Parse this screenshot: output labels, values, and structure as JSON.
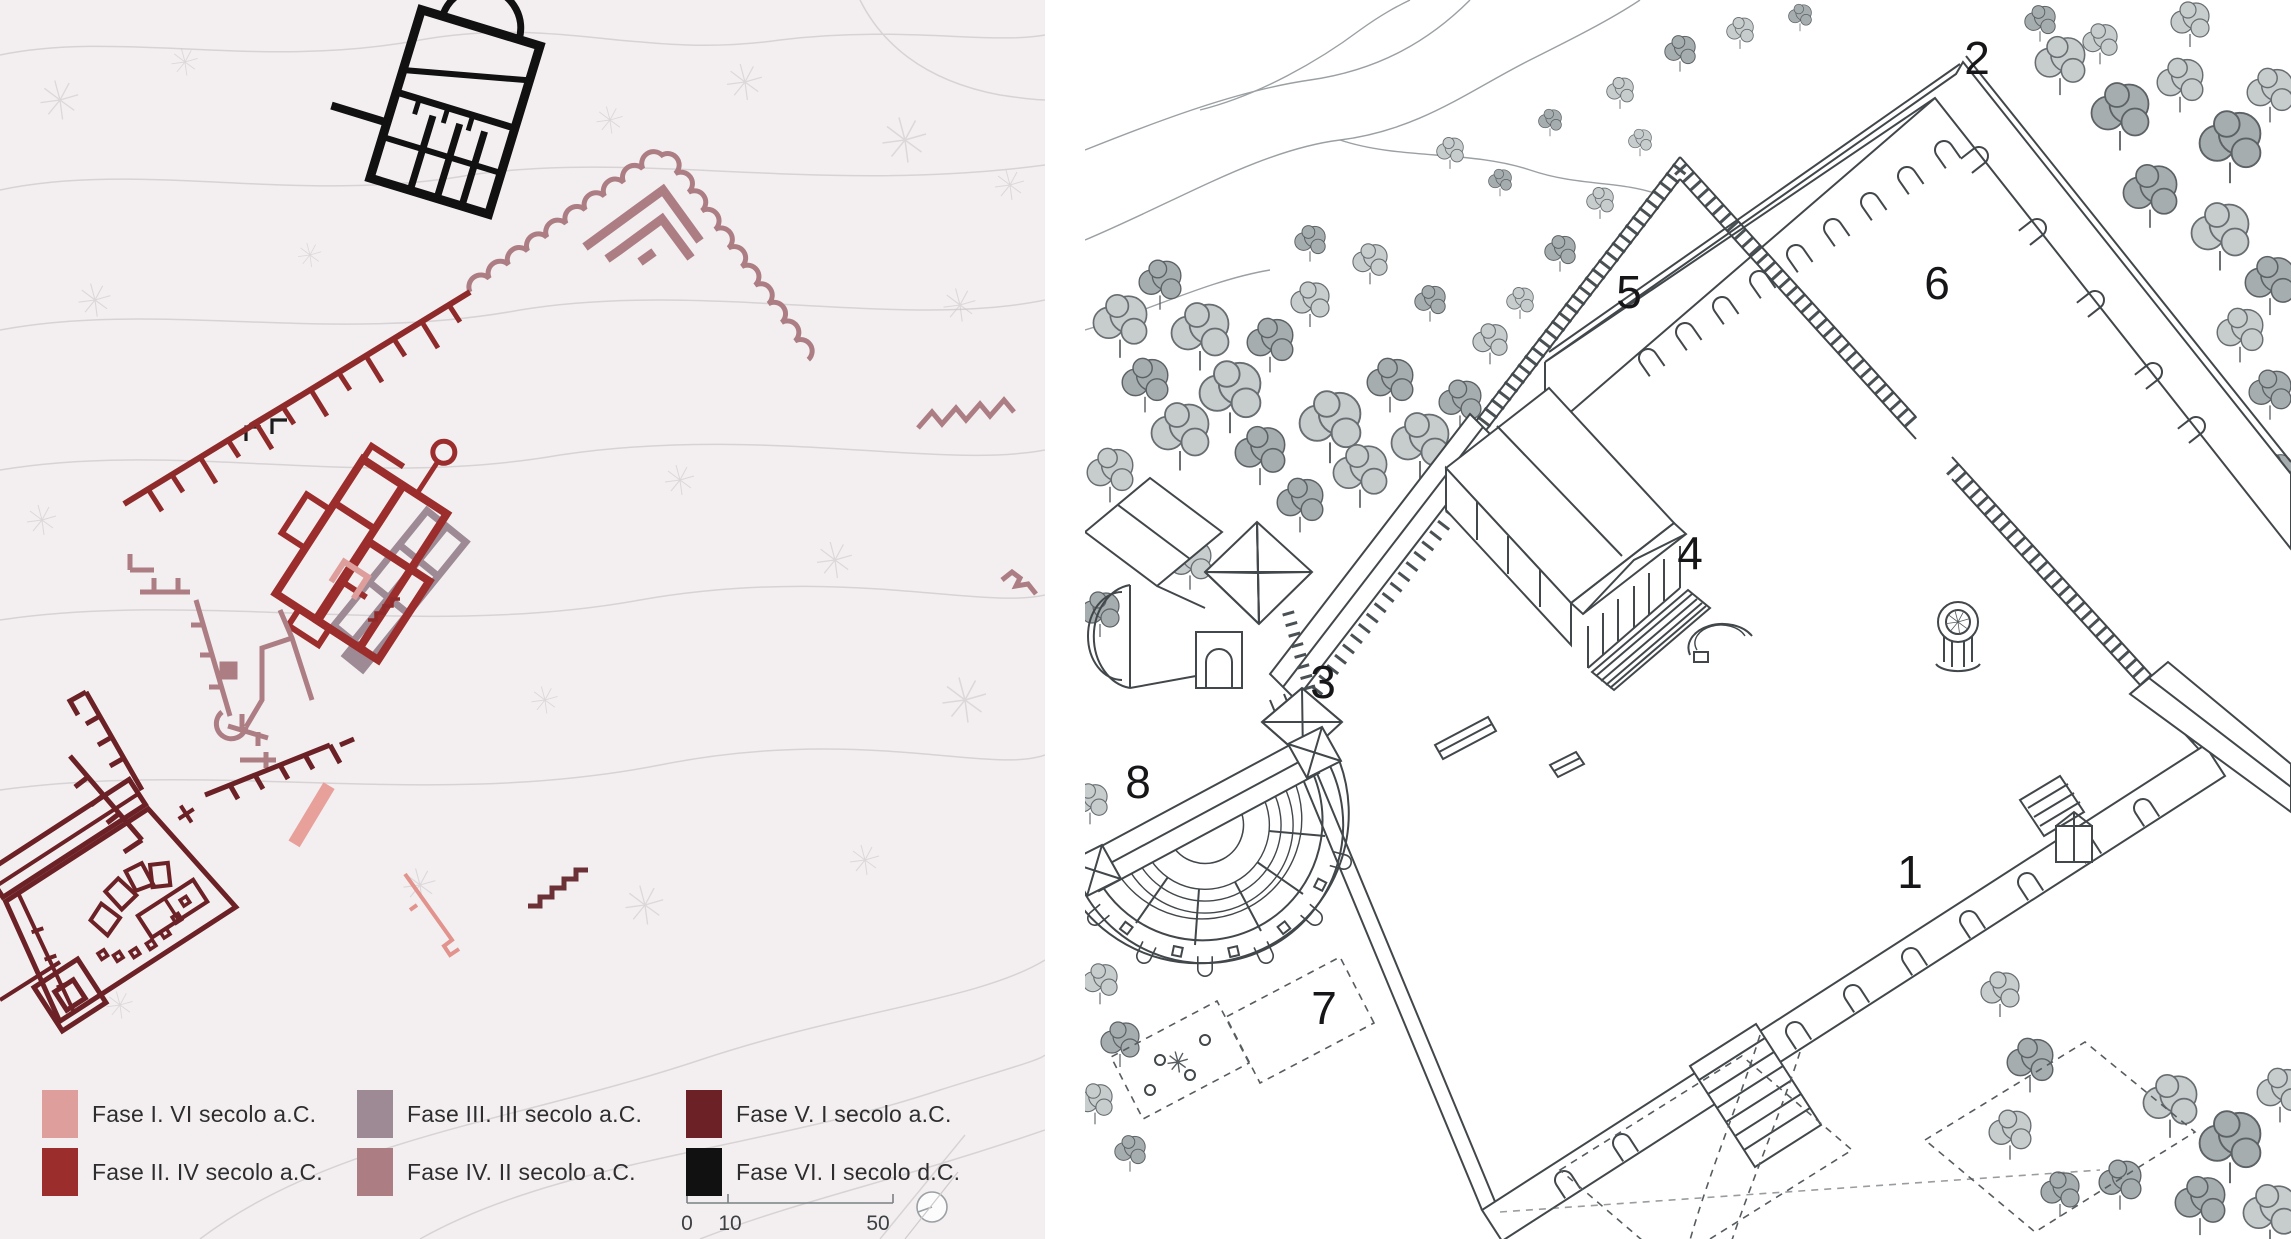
{
  "figure": {
    "left_panel": "site-phase-plan",
    "right_panel": "axonometric-reconstruction"
  },
  "legend": {
    "items": [
      {
        "label": "Fase I. VI secolo a.C.",
        "color": "#dd9e9c"
      },
      {
        "label": "Fase II. IV secolo a.C.",
        "color": "#9b2d2c"
      },
      {
        "label": "Fase III. III secolo a.C.",
        "color": "#9d8a94"
      },
      {
        "label": "Fase IV. II secolo a.C.",
        "color": "#ad7d84"
      },
      {
        "label": "Fase V. I secolo a.C.",
        "color": "#6b2125"
      },
      {
        "label": "Fase VI. I secolo d.C.",
        "color": "#111111"
      }
    ]
  },
  "scale_bar": {
    "labels": [
      "0",
      "10",
      "50"
    ]
  },
  "reconstruction_labels": {
    "items": [
      {
        "text": "1"
      },
      {
        "text": "2"
      },
      {
        "text": "3"
      },
      {
        "text": "4"
      },
      {
        "text": "5"
      },
      {
        "text": "6"
      },
      {
        "text": "7"
      },
      {
        "text": "8"
      }
    ]
  },
  "phase_colors": {
    "fase1": "#dd9e9c",
    "fase2": "#9b2d2c",
    "fase3": "#9d8a94",
    "fase4": "#ad7d84",
    "fase5": "#6b2125",
    "fase6": "#111111"
  }
}
